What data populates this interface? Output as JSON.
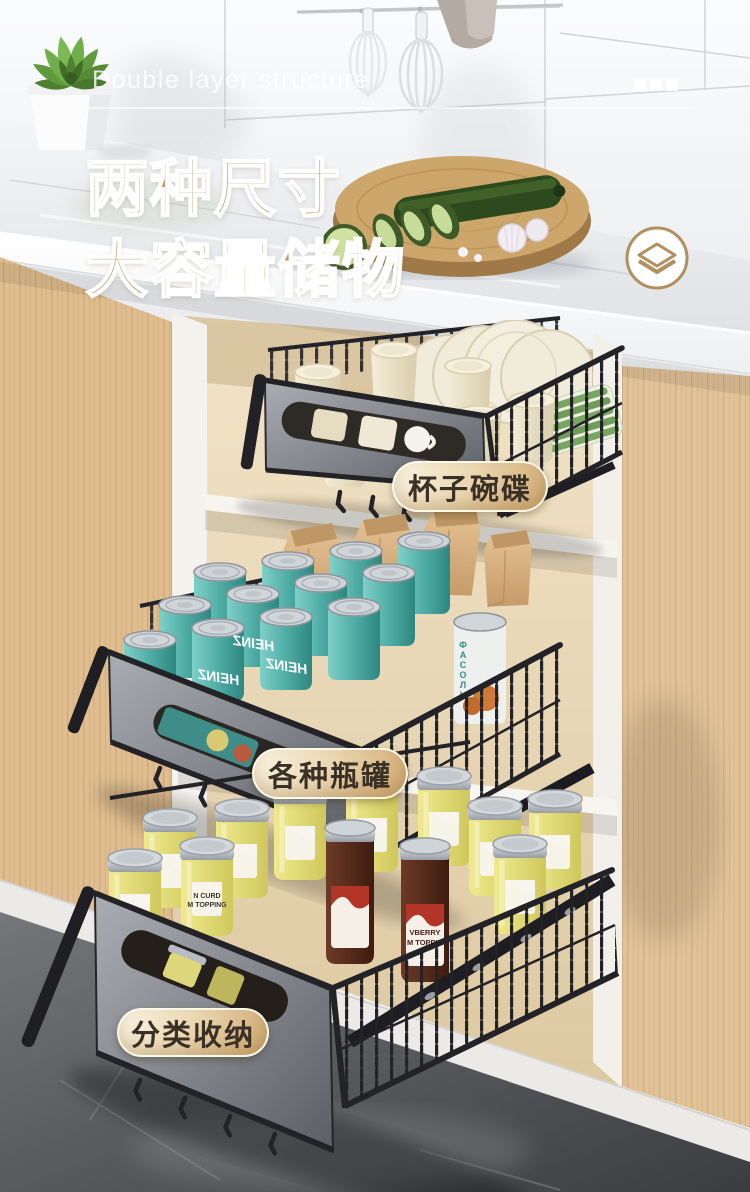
{
  "poster": {
    "subtitle_en": "Double layer structure",
    "title_line1": "两种尺寸",
    "title_line2": "大容量储物",
    "badge_top": "杯子碗碟",
    "badge_middle": "各种瓶罐",
    "badge_bottom": "分类收纳"
  },
  "products": {
    "can_brand": "HEINZ",
    "beans_can_text": "ФАСОЛЬ",
    "jar_yellow_line1": "N CURD",
    "jar_yellow_line2": "M TOPPING",
    "jar_dark_line1": "VBERRY",
    "jar_dark_line2": "M TOPPIN"
  },
  "colors": {
    "title_gold": "#c0986b",
    "badge_text": "#3a3126",
    "badge_gradient_start": "#faf4e3",
    "badge_gradient_end": "#cfa76f",
    "heinz_teal": "#4aa39d",
    "wood": "#e0be90",
    "floor_gray": "#55575a"
  }
}
